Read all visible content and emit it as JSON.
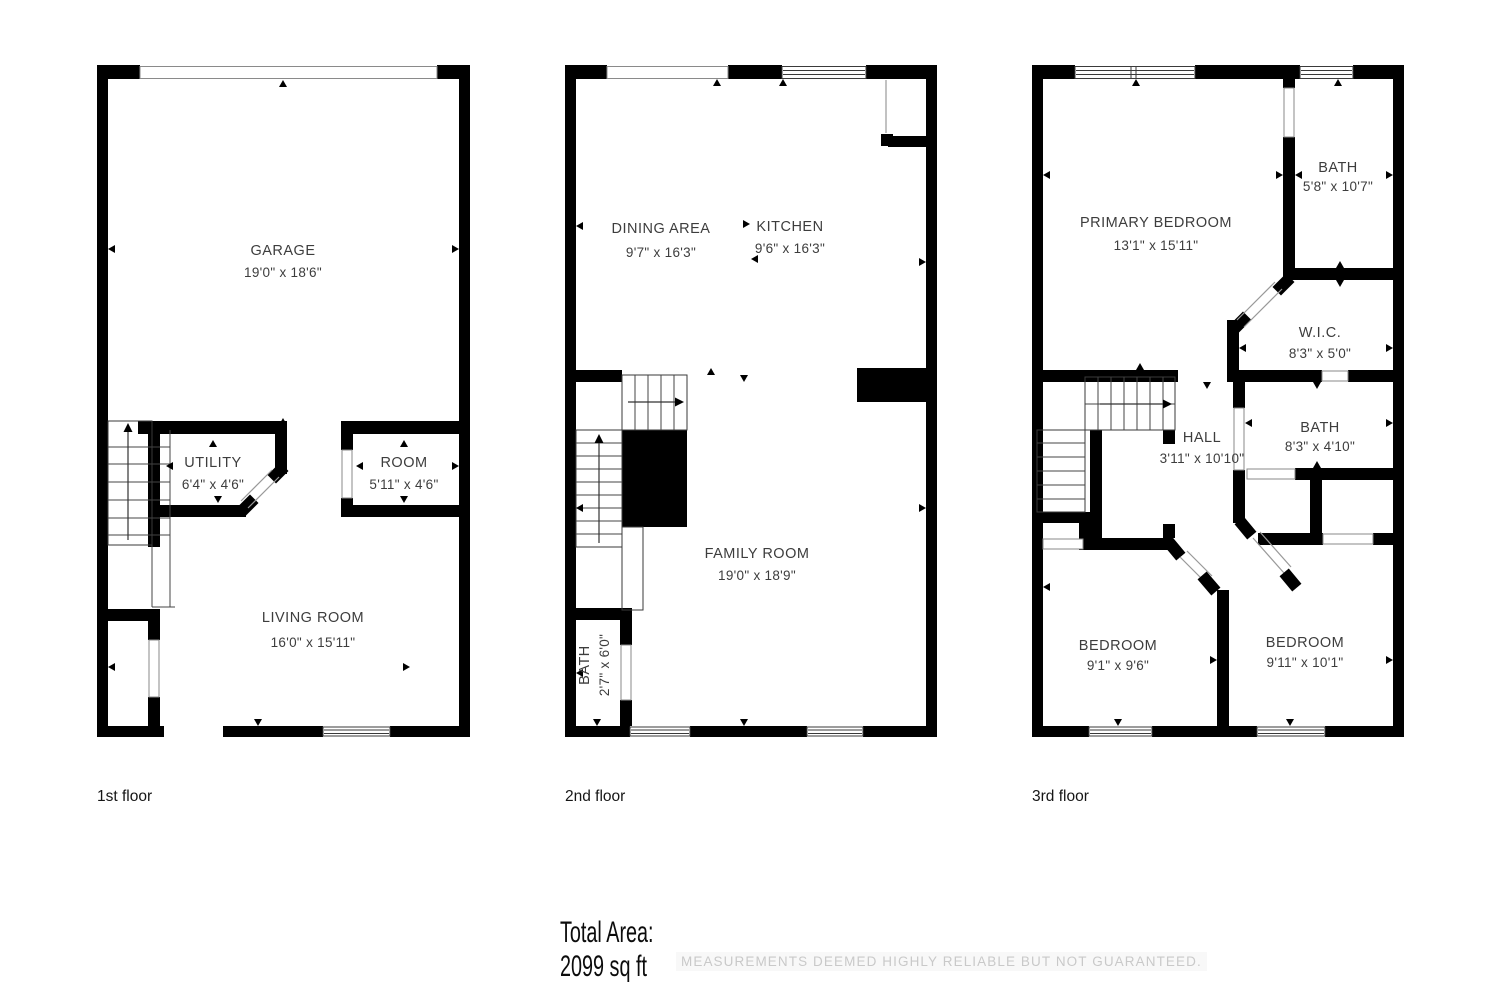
{
  "page": {
    "background": "#ffffff",
    "wall_color": "#000000",
    "room_text_color": "#3d3d3d",
    "disclaimer_color": "#c9c9c9"
  },
  "floors": [
    {
      "label": "1st floor",
      "rooms": [
        {
          "name": "GARAGE",
          "dims": "19'0\" x 18'6\""
        },
        {
          "name": "UTILITY",
          "dims": "6'4\" x 4'6\""
        },
        {
          "name": "ROOM",
          "dims": "5'11\" x 4'6\""
        },
        {
          "name": "LIVING ROOM",
          "dims": "16'0\" x 15'11\""
        }
      ]
    },
    {
      "label": "2nd floor",
      "rooms": [
        {
          "name": "DINING AREA",
          "dims": "9'7\" x 16'3\""
        },
        {
          "name": "KITCHEN",
          "dims": "9'6\" x 16'3\""
        },
        {
          "name": "FAMILY ROOM",
          "dims": "19'0\" x 18'9\""
        },
        {
          "name": "BATH",
          "dims": "2'7\" x 6'0\""
        }
      ]
    },
    {
      "label": "3rd floor",
      "rooms": [
        {
          "name": "PRIMARY BEDROOM",
          "dims": "13'1\" x 15'11\""
        },
        {
          "name": "BATH",
          "dims": "5'8\" x 10'7\""
        },
        {
          "name": "W.I.C.",
          "dims": "8'3\" x 5'0\""
        },
        {
          "name": "BATH",
          "dims": "8'3\" x 4'10\""
        },
        {
          "name": "HALL",
          "dims": "3'11\" x 10'10\""
        },
        {
          "name": "BEDROOM",
          "dims": "9'1\" x 9'6\""
        },
        {
          "name": "BEDROOM",
          "dims": "9'11\" x 10'1\""
        }
      ]
    }
  ],
  "footer": {
    "total_area_label": "Total Area:",
    "total_area_value": "2099 sq ft",
    "disclaimer": "MEASUREMENTS DEEMED HIGHLY RELIABLE BUT NOT GUARANTEED."
  }
}
